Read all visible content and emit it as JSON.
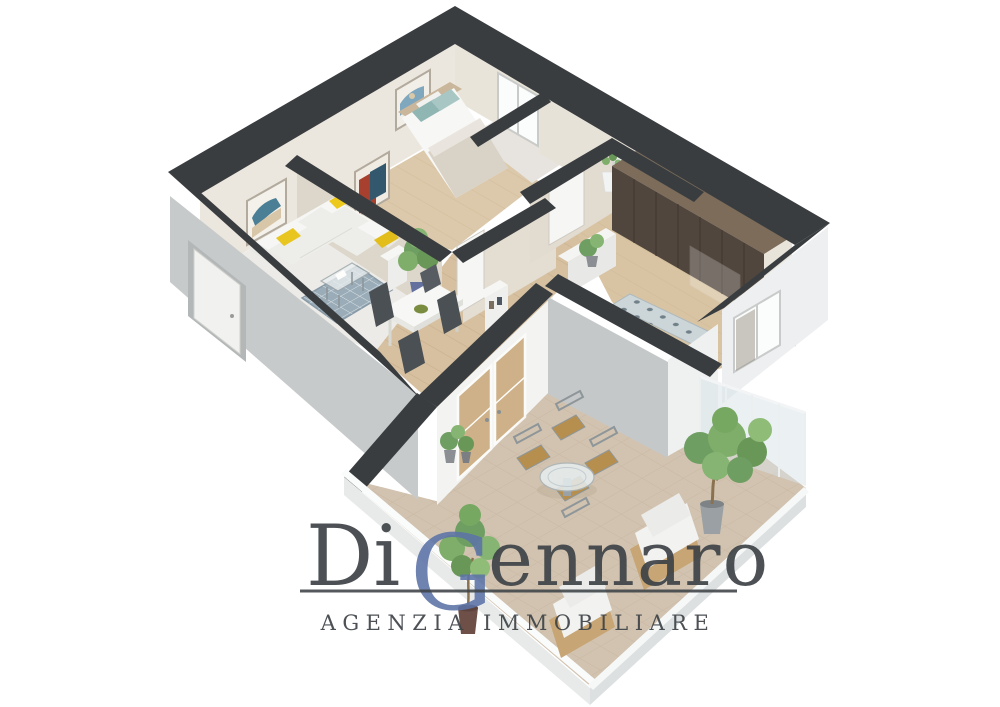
{
  "watermark": {
    "part1": "Di",
    "initial": "G",
    "part2": "ennaro",
    "subtitle": "AGENZIA IMMOBILIARE"
  },
  "colors": {
    "charcoal": "#3a3d40",
    "wallGray": "#c7cacb",
    "wallCream": "#ece7de",
    "wallCreamShade": "#ddd6ca",
    "woodFloor": "#d6c0a0",
    "woodLine": "#c4ab86",
    "terraceTile": "#d2c3b0",
    "terraceLine": "#bfae99",
    "rugBlue": "#9aacb8",
    "sofaWhite": "#f6f6f4",
    "accentYellow": "#e8c51f",
    "accentTeal": "#8fb6b3",
    "plantGreen": "#6f9e63",
    "wardrobeWood": "#51463d",
    "outdoorTan": "#b68f4e",
    "glass": "#d7e3e7",
    "parapet": "#e8eaea",
    "brandDark": "#3e4347",
    "brandBlue": "#5c73a7"
  },
  "scene": {
    "type": "3d-floorplan-render",
    "style": "isometric-cutaway-apartment",
    "rooms": [
      {
        "name": "living-room",
        "items": [
          "corner-sofa",
          "yellow-cushions",
          "blue-area-rug",
          "glass-coffee-table",
          "wall-art",
          "potted-plant",
          "side-unit"
        ]
      },
      {
        "name": "dining-area",
        "items": [
          "white-dining-table",
          "dark-chairs",
          "green-bowl"
        ]
      },
      {
        "name": "bedroom",
        "items": [
          "double-bed",
          "teal-pillows",
          "wall-art",
          "interior-door"
        ]
      },
      {
        "name": "bathroom",
        "items": [
          "window",
          "interior-door"
        ]
      },
      {
        "name": "hallway",
        "items": [
          "wood-floor",
          "console-shelf",
          "french-doors"
        ]
      },
      {
        "name": "wardrobe-room",
        "items": [
          "dark-wood-wardrobe",
          "sliding-glass-pane",
          "mosaic-runner-rug",
          "window"
        ]
      },
      {
        "name": "terrace",
        "items": [
          "round-glass-table",
          "four-outdoor-chairs",
          "two-lounge-armchairs",
          "potted-trees",
          "glass-railing",
          "white-parapet",
          "tiled-floor"
        ]
      }
    ]
  }
}
